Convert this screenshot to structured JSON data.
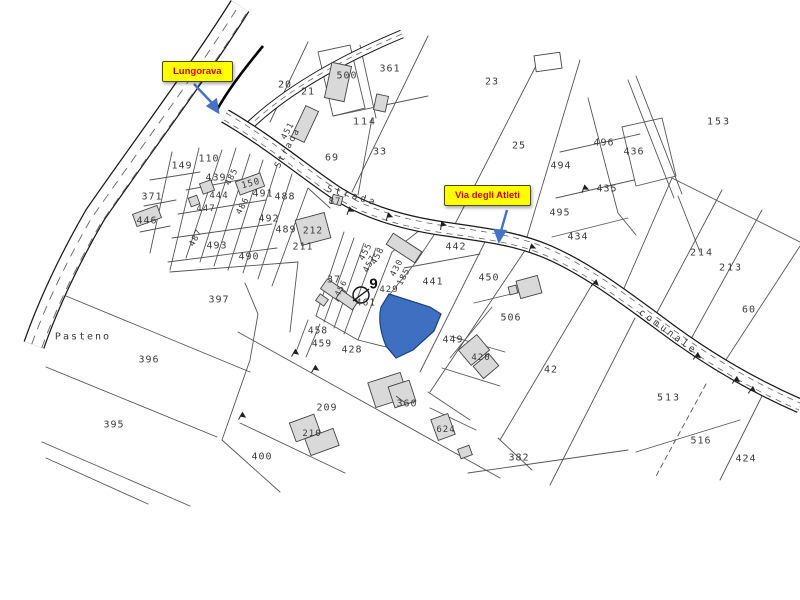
{
  "title": "Cadastral map extract",
  "callouts": [
    {
      "label": "Lungorava"
    },
    {
      "label": "Via degli Atleti"
    }
  ],
  "callout_style": {
    "background": "#ffff00",
    "text_color": "#d40000",
    "arrow_color": "#4472c4"
  },
  "highlighted_parcel": {
    "fill": "#3f6fc1",
    "outline": "#1c4284"
  },
  "map_style": {
    "line_color": "#555555",
    "building_fill": "#d9d9d9",
    "road_casing": "#1a1a1a",
    "text_color": "#3a3a3a"
  },
  "place_names": [
    "Pasteno"
  ],
  "road_names": [
    "Strada",
    "Strada",
    "comunale"
  ],
  "map_labels": [
    {
      "t": "20",
      "x": 285,
      "y": 85
    },
    {
      "t": "21",
      "x": 308,
      "y": 92
    },
    {
      "t": "500",
      "x": 347,
      "y": 76
    },
    {
      "t": "361",
      "x": 390,
      "y": 69
    },
    {
      "t": "23",
      "x": 492,
      "y": 82
    },
    {
      "t": "114",
      "x": 365,
      "y": 122,
      "ls": 2
    },
    {
      "t": "69",
      "x": 332,
      "y": 158
    },
    {
      "t": "33",
      "x": 380,
      "y": 152
    },
    {
      "t": "25",
      "x": 519,
      "y": 146
    },
    {
      "t": "496",
      "x": 604,
      "y": 143
    },
    {
      "t": "436",
      "x": 634,
      "y": 152
    },
    {
      "t": "153",
      "x": 719,
      "y": 122,
      "ls": 2
    },
    {
      "t": "494",
      "x": 561,
      "y": 166
    },
    {
      "t": "435",
      "x": 607,
      "y": 189
    },
    {
      "t": "495",
      "x": 560,
      "y": 213
    },
    {
      "t": "434",
      "x": 578,
      "y": 237
    },
    {
      "t": "214",
      "x": 702,
      "y": 253,
      "ls": 2
    },
    {
      "t": "213",
      "x": 731,
      "y": 268,
      "ls": 2
    },
    {
      "t": "60",
      "x": 749,
      "y": 310
    },
    {
      "t": "149",
      "x": 182,
      "y": 166
    },
    {
      "t": "110",
      "x": 209,
      "y": 159
    },
    {
      "t": "439",
      "x": 216,
      "y": 178
    },
    {
      "t": "485",
      "x": 232,
      "y": 177,
      "r": -62,
      "fs": 8.5
    },
    {
      "t": "451",
      "x": 288,
      "y": 131,
      "r": -62,
      "fs": 8.5
    },
    {
      "t": "371",
      "x": 152,
      "y": 197
    },
    {
      "t": "444",
      "x": 219,
      "y": 196,
      "fs": 9
    },
    {
      "t": "447",
      "x": 206,
      "y": 209,
      "fs": 9
    },
    {
      "t": "486",
      "x": 243,
      "y": 206,
      "r": -62,
      "fs": 8.5
    },
    {
      "t": "446",
      "x": 147,
      "y": 221
    },
    {
      "t": "491",
      "x": 263,
      "y": 194
    },
    {
      "t": "150",
      "x": 251,
      "y": 184,
      "r": -15,
      "fs": 9
    },
    {
      "t": "488",
      "x": 285,
      "y": 197
    },
    {
      "t": "492",
      "x": 269,
      "y": 219
    },
    {
      "t": "489",
      "x": 286,
      "y": 230
    },
    {
      "t": "487",
      "x": 196,
      "y": 238,
      "r": -62,
      "fs": 8.5
    },
    {
      "t": "493",
      "x": 217,
      "y": 246
    },
    {
      "t": "490",
      "x": 249,
      "y": 257
    },
    {
      "t": "212",
      "x": 313,
      "y": 231,
      "fs": 9.5
    },
    {
      "t": "211",
      "x": 303,
      "y": 247
    },
    {
      "t": "87",
      "x": 335,
      "y": 202,
      "fs": 9
    },
    {
      "t": "397",
      "x": 219,
      "y": 300
    },
    {
      "t": "396",
      "x": 149,
      "y": 360
    },
    {
      "t": "395",
      "x": 114,
      "y": 425
    },
    {
      "t": "400",
      "x": 262,
      "y": 457
    },
    {
      "t": "37",
      "x": 334,
      "y": 280
    },
    {
      "t": "455",
      "x": 366,
      "y": 252,
      "r": -62,
      "fs": 8.5
    },
    {
      "t": "457",
      "x": 370,
      "y": 264,
      "r": -62,
      "fs": 8.5
    },
    {
      "t": "458",
      "x": 378,
      "y": 256,
      "r": -62,
      "fs": 8.5
    },
    {
      "t": "430",
      "x": 397,
      "y": 268,
      "r": -62,
      "fs": 8.5
    },
    {
      "t": "185",
      "x": 404,
      "y": 277,
      "r": -62,
      "fs": 8.5
    },
    {
      "t": "456",
      "x": 341,
      "y": 288,
      "r": -62,
      "fs": 8
    },
    {
      "t": "9",
      "x": 374,
      "y": 284,
      "fs": 15,
      "b": true
    },
    {
      "t": "429",
      "x": 389,
      "y": 290,
      "fs": 9
    },
    {
      "t": "461",
      "x": 366,
      "y": 303,
      "fs": 9.5
    },
    {
      "t": "442",
      "x": 456,
      "y": 247
    },
    {
      "t": "441",
      "x": 433,
      "y": 282
    },
    {
      "t": "450",
      "x": 489,
      "y": 278
    },
    {
      "t": "506",
      "x": 511,
      "y": 318
    },
    {
      "t": "449",
      "x": 453,
      "y": 340
    },
    {
      "t": "42",
      "x": 551,
      "y": 370
    },
    {
      "t": "420",
      "x": 481,
      "y": 358,
      "fs": 9
    },
    {
      "t": "458",
      "x": 318,
      "y": 331,
      "fs": 9.5
    },
    {
      "t": "459",
      "x": 322,
      "y": 344,
      "fs": 9.5
    },
    {
      "t": "428",
      "x": 352,
      "y": 350
    },
    {
      "t": "360",
      "x": 407,
      "y": 404
    },
    {
      "t": "209",
      "x": 327,
      "y": 408
    },
    {
      "t": "210",
      "x": 312,
      "y": 434,
      "fs": 9
    },
    {
      "t": "624",
      "x": 446,
      "y": 430,
      "fs": 9
    },
    {
      "t": "382",
      "x": 519,
      "y": 458
    },
    {
      "t": "513",
      "x": 669,
      "y": 398,
      "ls": 2
    },
    {
      "t": "516",
      "x": 701,
      "y": 441
    },
    {
      "t": "424",
      "x": 746,
      "y": 459
    },
    {
      "t": "Strada",
      "x": 288,
      "y": 148,
      "r": -62,
      "fs": 9,
      "ls": 2,
      "n": "road-name-strada-branch"
    },
    {
      "t": "Strada",
      "x": 352,
      "y": 196,
      "r": 16,
      "fs": 9.5,
      "ls": 3,
      "n": "road-name-strada-main"
    },
    {
      "t": "comunale",
      "x": 668,
      "y": 332,
      "r": 36,
      "fs": 9.5,
      "ls": 3,
      "n": "road-name-comunale"
    },
    {
      "t": "Pasteno",
      "x": 83,
      "y": 337,
      "fs": 10,
      "ls": 2,
      "n": "place-name-pasteno"
    }
  ]
}
